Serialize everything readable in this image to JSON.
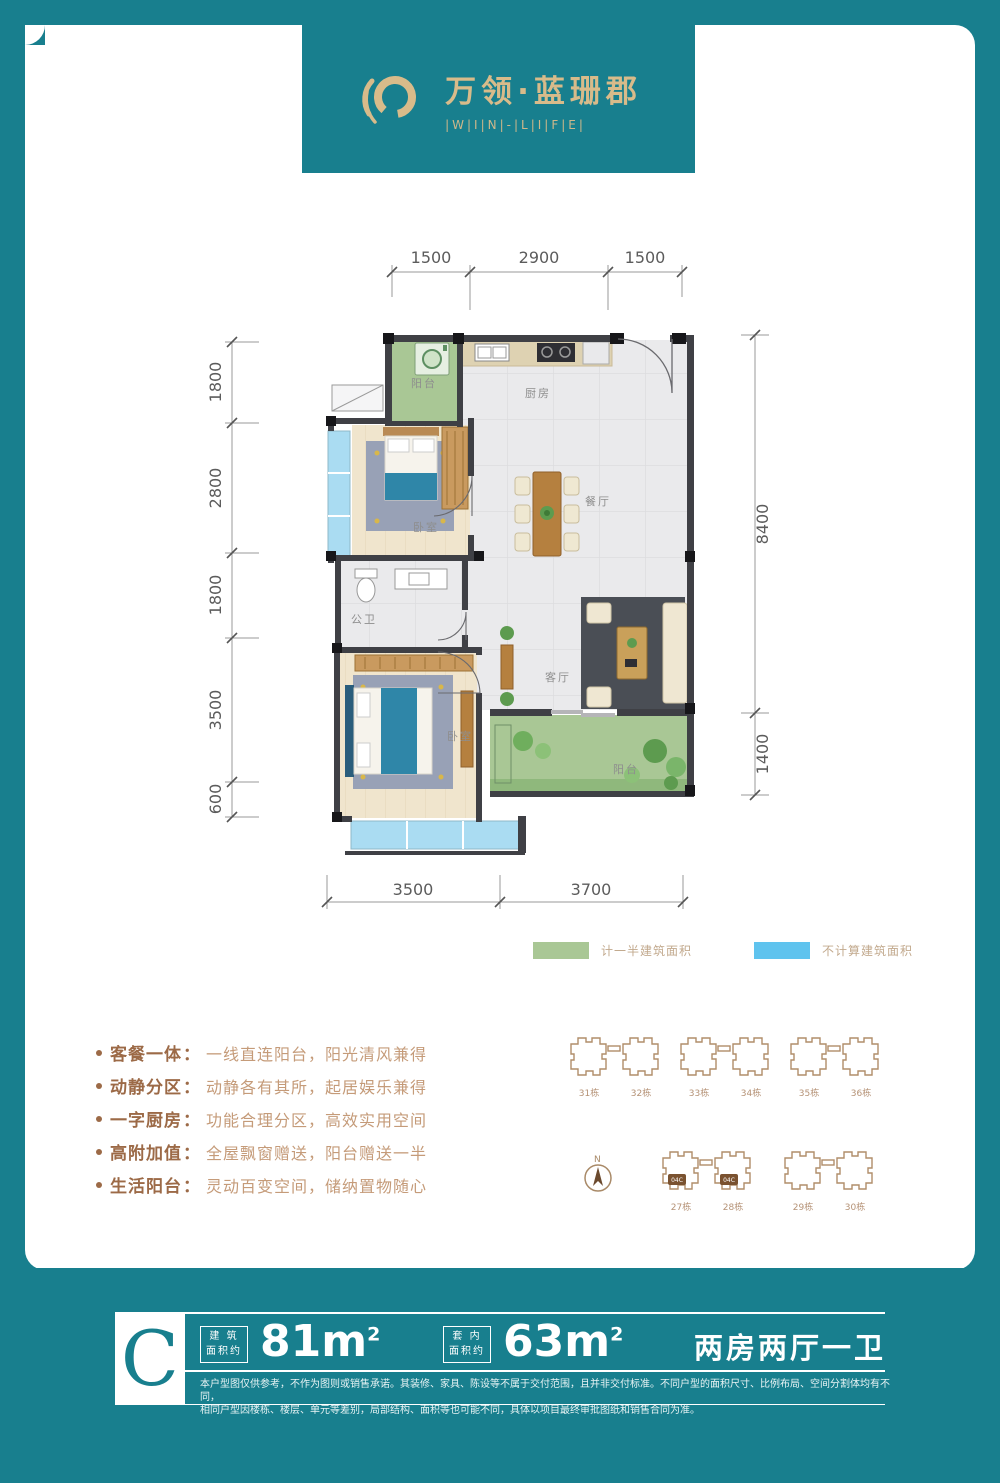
{
  "brand": {
    "title": "万领·蓝珊郡",
    "subtitle": "|W|I|N|-|L|I|F|E|",
    "icon": "swirl-ring-icon",
    "gold": "#d8bb8a",
    "teal": "#187f8e"
  },
  "plan": {
    "dims_top": [
      "1500",
      "2900",
      "1500"
    ],
    "dims_left": [
      "1800",
      "2800",
      "1800",
      "3500",
      "600"
    ],
    "dims_right": [
      "8400",
      "1400"
    ],
    "dims_bottom": [
      "3500",
      "3700"
    ],
    "rooms": {
      "balcony_top": "阳台",
      "kitchen": "厨房",
      "bedroom2": "卧室",
      "dining": "餐厅",
      "bath": "公卫",
      "master": "卧室",
      "living": "客厅",
      "balcony_bottom": "阳台"
    }
  },
  "legend": {
    "half_area": {
      "label": "计一半建筑面积",
      "color": "#a9c795"
    },
    "excluded": {
      "label": "不计算建筑面积",
      "color": "#5fc3ee"
    }
  },
  "features": [
    {
      "label": "客餐一体",
      "colon": "：",
      "desc": "一线直连阳台，阳光清风兼得"
    },
    {
      "label": "动静分区",
      "colon": "：",
      "desc": "动静各有其所，起居娱乐兼得"
    },
    {
      "label": "一字厨房",
      "colon": "：",
      "desc": "功能合理分区，高效实用空间"
    },
    {
      "label": "高附加值",
      "colon": "：",
      "desc": "全屋飘窗赠送，阳台赠送一半"
    },
    {
      "label": "生活阳台",
      "colon": "：",
      "desc": "灵动百变空间，储纳置物随心"
    }
  ],
  "siteplan": {
    "compass": "N",
    "row1": [
      "31栋",
      "32栋",
      "33栋",
      "34栋",
      "35栋",
      "36栋"
    ],
    "row2": [
      "27栋",
      "28栋",
      "29栋",
      "30栋"
    ],
    "highlight_unit": "04C"
  },
  "summary": {
    "unit": "C",
    "area_built_label_1": "建 筑",
    "area_built_label_2": "面积约",
    "area_built_value": "81m",
    "area_built_sup": "2",
    "area_inner_label_1": "套 内",
    "area_inner_label_2": "面积约",
    "area_inner_value": "63m",
    "area_inner_sup": "2",
    "layout": "两房两厅一卫"
  },
  "disclaimer": {
    "line1": "本户型图仅供参考，不作为图则或销售承诺。其装修、家具、陈设等不属于交付范围，且并非交付标准。不同户型的面积尺寸、比例布局、空间分割体均有不同，",
    "line2": "相同户型因楼栋、楼层、单元等差别，局部结构、面积等也可能不同，具体以项目最终审批图纸和销售合同为准。"
  }
}
